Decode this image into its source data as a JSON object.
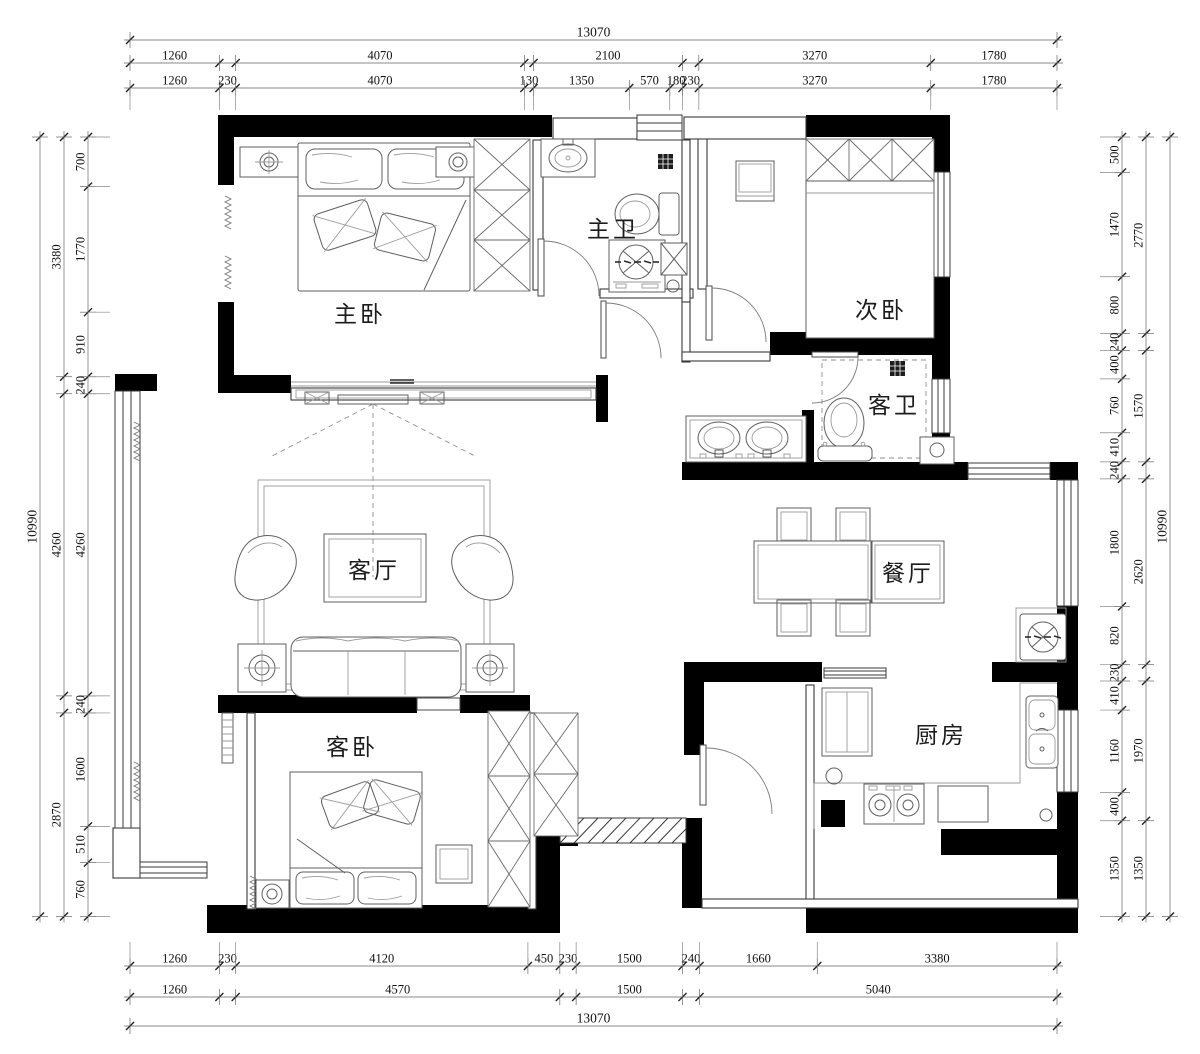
{
  "rooms": {
    "master_bedroom": "主卧",
    "master_bath": "主卫",
    "second_bedroom": "次卧",
    "guest_bath": "客卫",
    "living_room": "客厅",
    "dining_room": "餐厅",
    "guest_bedroom": "客卧",
    "kitchen": "厨房"
  },
  "dimensions": {
    "top": {
      "overall": "13070",
      "row_a": [
        [
          1260,
          "1260"
        ],
        [
          230,
          ""
        ],
        [
          4070,
          "4070"
        ],
        [
          130,
          ""
        ],
        [
          2100,
          "2100"
        ],
        [
          230,
          ""
        ],
        [
          3270,
          "3270"
        ],
        [
          1780,
          "1780"
        ]
      ],
      "row_b": [
        [
          1260,
          "1260"
        ],
        [
          230,
          "230"
        ],
        [
          4070,
          "4070"
        ],
        [
          130,
          "130"
        ],
        [
          1350,
          "1350"
        ],
        [
          570,
          "570"
        ],
        [
          180,
          "180"
        ],
        [
          230,
          "230"
        ],
        [
          3270,
          "3270"
        ],
        [
          1780,
          "1780"
        ]
      ]
    },
    "bottom": {
      "overall": "13070",
      "row_a": [
        [
          1260,
          "1260"
        ],
        [
          230,
          "230"
        ],
        [
          4120,
          "4120"
        ],
        [
          450,
          "450"
        ],
        [
          230,
          "230"
        ],
        [
          1500,
          "1500"
        ],
        [
          240,
          "240"
        ],
        [
          1660,
          "1660"
        ],
        [
          3380,
          "3380"
        ]
      ],
      "row_b": [
        [
          1260,
          "1260"
        ],
        [
          230,
          ""
        ],
        [
          4570,
          "4570"
        ],
        [
          230,
          ""
        ],
        [
          1500,
          "1500"
        ],
        [
          240,
          ""
        ],
        [
          5040,
          "5040"
        ]
      ]
    },
    "left": {
      "overall": "10990",
      "col_mid": [
        [
          3380,
          "3380"
        ],
        [
          240,
          ""
        ],
        [
          4260,
          "4260"
        ],
        [
          240,
          ""
        ],
        [
          2870,
          "2870"
        ]
      ],
      "col_inner": [
        [
          700,
          "700"
        ],
        [
          1770,
          "1770"
        ],
        [
          910,
          "910"
        ],
        [
          240,
          "240"
        ],
        [
          4260,
          "4260"
        ],
        [
          240,
          "240"
        ],
        [
          1600,
          "1600"
        ],
        [
          510,
          "510"
        ],
        [
          760,
          "760"
        ]
      ]
    },
    "right": {
      "overall": "10990",
      "col_mid": [
        [
          2770,
          "2770"
        ],
        [
          240,
          ""
        ],
        [
          1570,
          "1570"
        ],
        [
          240,
          ""
        ],
        [
          2620,
          "2620"
        ],
        [
          230,
          ""
        ],
        [
          1970,
          "1970"
        ],
        [
          1350,
          "1350"
        ]
      ],
      "col_inner": [
        [
          500,
          "500"
        ],
        [
          1470,
          "1470"
        ],
        [
          800,
          "800"
        ],
        [
          240,
          "240"
        ],
        [
          400,
          "400"
        ],
        [
          760,
          "760"
        ],
        [
          410,
          "410"
        ],
        [
          240,
          "240"
        ],
        [
          1800,
          "1800"
        ],
        [
          820,
          "820"
        ],
        [
          230,
          "230"
        ],
        [
          410,
          "410"
        ],
        [
          1160,
          "1160"
        ],
        [
          400,
          "400"
        ],
        [
          1350,
          "1350"
        ]
      ]
    }
  },
  "colors": {
    "wall": "#000000",
    "line": "#5f5f5f",
    "dim_text": "#111111",
    "background": "#ffffff"
  }
}
